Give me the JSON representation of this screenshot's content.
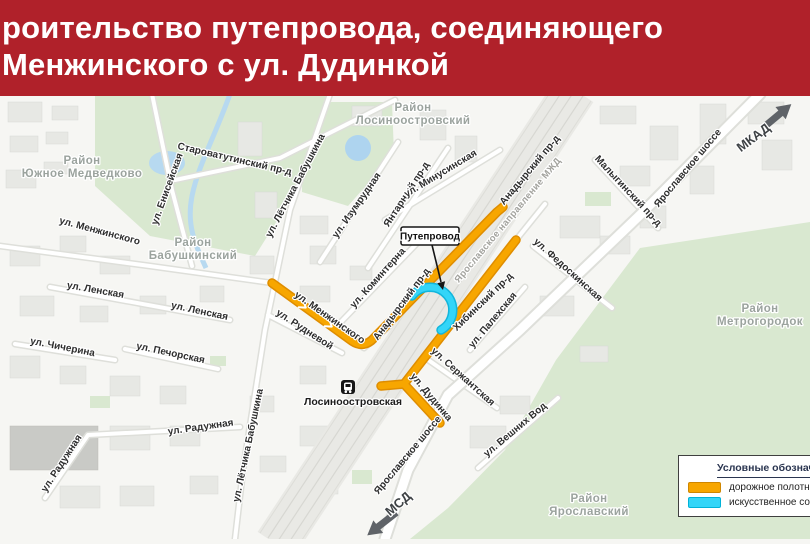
{
  "header": {
    "title_line1": "роительство путепровода, соединяющего",
    "title_line2": "Менжинского с ул. Дудинкой"
  },
  "map": {
    "districts": {
      "yuzhnoe_medvedkovo": {
        "line1": "Район",
        "line2": "Южное Медведково"
      },
      "losinoostrovsky": {
        "line1": "Район",
        "line2": "Лосиноостровский"
      },
      "babushkinsky": {
        "line1": "Район",
        "line2": "Бабушкинский"
      },
      "metrogorodok": {
        "line1": "Район",
        "line2": "Метрогородок"
      },
      "yaroslavsky": {
        "line1": "Район",
        "line2": "Ярославский"
      }
    },
    "streets": {
      "starovatutinsky": "Староватутинский пр-д",
      "eniseyskaya": "ул. Енисейская",
      "letchika_babushkina_n": "ул. Лётчика Бабушкина",
      "letchika_babushkina_s": "ул. Лётчика Бабушкина",
      "menzhinskogo_nw": "ул. Менжинского",
      "menzhinskogo_c": "ул. Менжинского",
      "izumrudnaya": "ул. Изумрудная",
      "yantarny": "Янтарный пр-д",
      "minusinskaya": "ул. Минусинская",
      "anadyrsky_ne": "Анадырский пр-д",
      "anadyrsky_c": "Анадырский пр-д",
      "malyginsky": "Малыгинский пр-д",
      "yaroslavskoe_n": "Ярославское шоссе",
      "yaroslavskoe_s": "Ярославское шоссе",
      "komintern": "ул. Коминтерна",
      "rudnevoy": "ул. Рудневой",
      "lenskaya_1": "ул. Ленская",
      "lenskaya_2": "ул. Ленская",
      "chicherina": "ул. Чичерина",
      "pechorskaya": "ул. Печорская",
      "raduzhnaya_1": "ул. Радужная",
      "raduzhnaya_2": "ул. Радужная",
      "khibinsky": "Хибинский пр-д",
      "palekhskaya": "ул. Палехская",
      "serzhantskaya": "ул. Сержантская",
      "dudinka": "ул. Дудинка",
      "fedoskinskaya": "ул. Федоскинская",
      "veshnikh_vod": "ул. Вешних Вод"
    },
    "landmarks": {
      "station": "Лосиноостровская",
      "railway_line": "Ярославское направление МЖД",
      "mkad": "МКАД",
      "msd": "МСД"
    },
    "callout": {
      "label": "Путепровод"
    }
  },
  "legend": {
    "title": "Условные обозначения",
    "road_label": "дорожное полотно",
    "structure_label": "искусственное сооружение",
    "road_color": "#f7a600",
    "structure_color": "#33d5f8"
  },
  "colors": {
    "header_bg": "#b0212a",
    "road_orange": "#f7a600",
    "overpass_cyan": "#33d5f8",
    "park_green": "#d9e8d0",
    "water_blue": "#b7d9f0",
    "district_gray": "#9ba39e"
  }
}
